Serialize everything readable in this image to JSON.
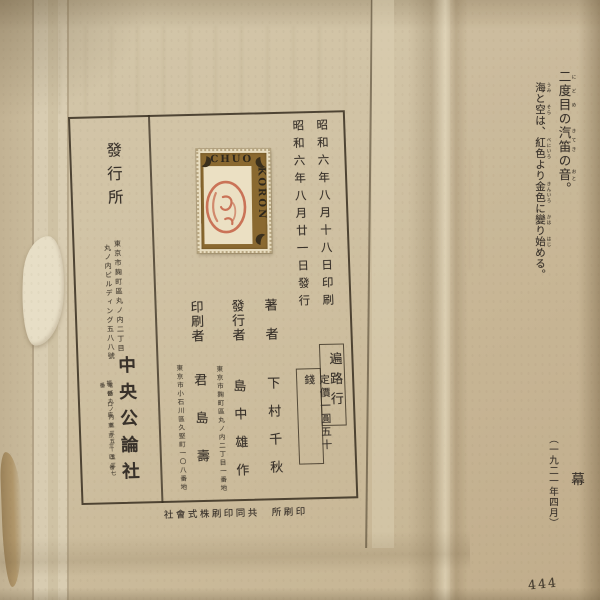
{
  "colors": {
    "paper": "#cfc2a4",
    "ink": "#38312a",
    "stamp_brown": "#8a6930",
    "stamp_paper": "#e9dec2",
    "seal_red": "#c05a3c"
  },
  "right_page": {
    "lines": [
      {
        "segments": [
          {
            "t": "二度目",
            "r": "にどめ"
          },
          {
            "t": "の"
          },
          {
            "t": "汽笛",
            "r": "きてき"
          },
          {
            "t": "の"
          },
          {
            "t": "音",
            "r": "おと"
          },
          {
            "t": "。"
          }
        ]
      },
      {
        "segments": [
          {
            "t": "海",
            "r": "うみ"
          },
          {
            "t": "と"
          },
          {
            "t": "空",
            "r": "そら"
          },
          {
            "t": "は、"
          },
          {
            "t": "紅色",
            "r": "べにいろ"
          },
          {
            "t": "より"
          },
          {
            "t": "金色",
            "r": "きんいろ"
          },
          {
            "t": "に"
          },
          {
            "t": "變",
            "r": "かは"
          },
          {
            "t": "り"
          },
          {
            "t": "始",
            "r": "はじ"
          },
          {
            "t": "める。"
          }
        ]
      }
    ],
    "ending_mark": "幕",
    "date_note": "（一九二一年四月）",
    "page_number": "444"
  },
  "colophon": {
    "print_date": "昭和六年八月十八日印刷",
    "publish_date": "昭和六年八月廿一日發行",
    "stamp": {
      "top_text": "CHUO",
      "side_text": "KORON"
    },
    "office_label": "發行所",
    "office_address_line1": "東京市麹町區丸ノ内二丁目",
    "office_address_line2": "丸ノ内ビルディング五八八號",
    "office_name": "中央公論社",
    "office_postal_note": "振替口座東京三四番",
    "office_phone_note": "電話丸ノ内五三五—五三七番",
    "author_label": "著者",
    "author_name": "下村千秋",
    "publisher_label": "發行者",
    "publisher_name": "島中雄作",
    "publisher_address": "東京市麹町區丸ノ内二丁目一番地",
    "printer_label": "印刷者",
    "printer_name": "君島壽",
    "printer_address": "東京市小石川區久堅町一〇八番地",
    "title_box_label": "遍路行",
    "price_label": "定價一圓五十錢",
    "printing_company_caption_rtl": "社會式株刷印同共　所刷印"
  }
}
